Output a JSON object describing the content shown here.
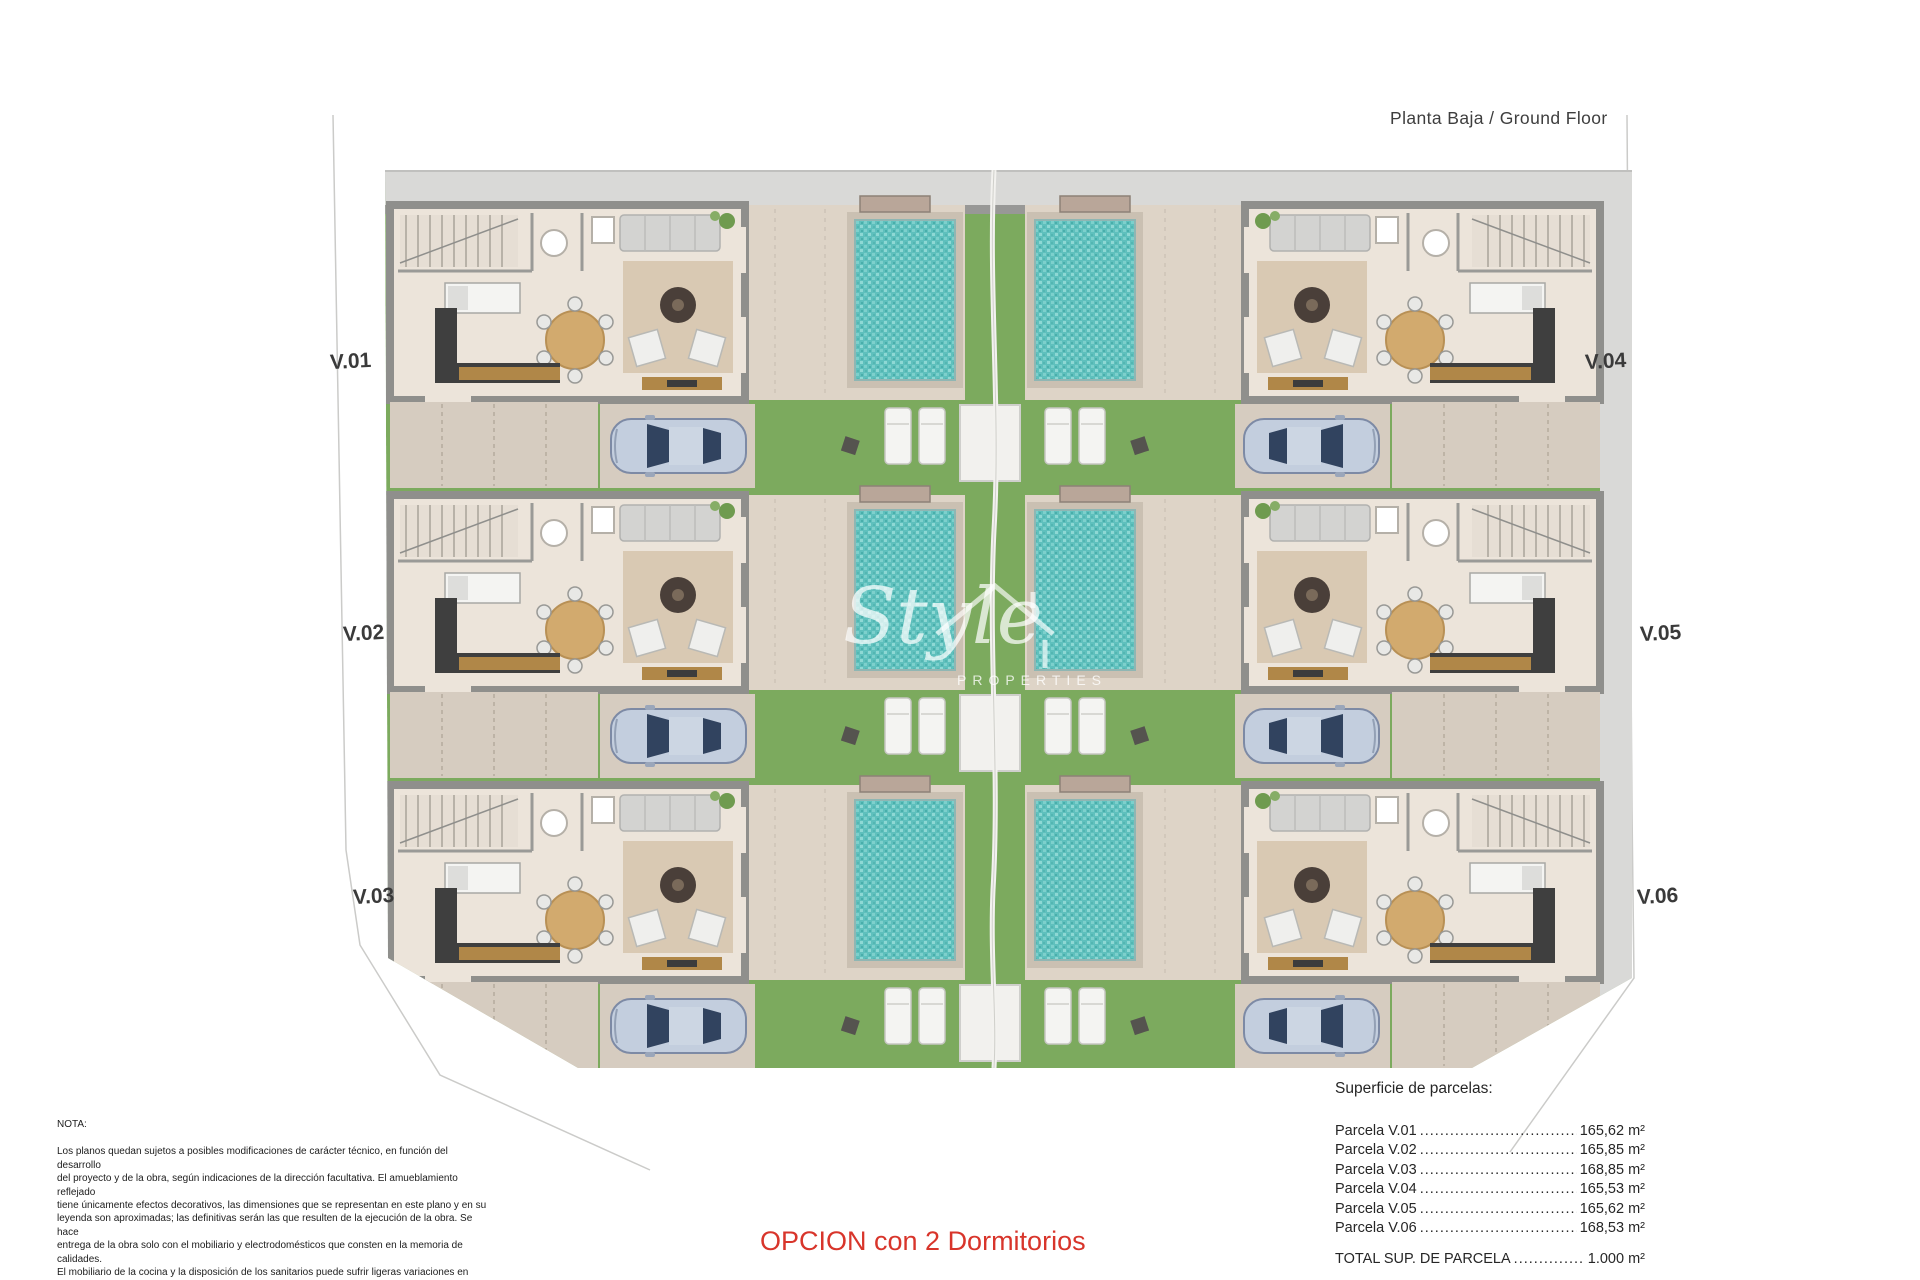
{
  "header": {
    "title": "Planta Baja / Ground Floor"
  },
  "plan": {
    "labels": [
      "V.01",
      "V.02",
      "V.03",
      "V.04",
      "V.05",
      "V.06"
    ],
    "rows": 3,
    "villas_per_row": 2,
    "features": [
      "pool",
      "garden",
      "parking",
      "loungers",
      "central-path"
    ]
  },
  "watermark": {
    "brand": "Style",
    "sub": "PROPERTIES",
    "logo": "house-outline-icon"
  },
  "nota": {
    "heading": "NOTA:",
    "lines": [
      "Los planos quedan sujetos a posibles modificaciones de carácter técnico, en función del desarrollo",
      "del proyecto y de la obra, según indicaciones de la dirección facultativa. El amueblamiento reflejado",
      "tiene únicamente efectos decorativos, las dimensiones que se representan en este plano y en su",
      "leyenda son aproximadas; las definitivas serán las que resulten de la ejecución de la obra. Se hace",
      "entrega de la obra solo con el mobiliario y electrodomésticos que consten en la memoria de calidades.",
      "El mobiliario de la cocina y la disposición de los sanitarios puede sufrir ligeras variaciones en función",
      "del montaje definitivo."
    ]
  },
  "option_label": "OPCION con 2 Dormitorios",
  "parcelas": {
    "heading": "Superficie de parcelas:",
    "leader": "........................................",
    "rows": [
      {
        "label": "Parcela V.01",
        "value": "165,62 m²"
      },
      {
        "label": "Parcela V.02",
        "value": "165,85 m²"
      },
      {
        "label": "Parcela V.03",
        "value": "168,85 m²"
      },
      {
        "label": "Parcela V.04",
        "value": "165,53 m²"
      },
      {
        "label": "Parcela V.05",
        "value": "165,62 m²"
      },
      {
        "label": "Parcela V.06",
        "value": "168,53 m²"
      }
    ],
    "total": {
      "label": "TOTAL SUP. DE PARCELA",
      "value": "1.000 m²"
    }
  },
  "colors": {
    "accent_red": "#d8352b",
    "grass": "#7caa5e",
    "pool_water": "#5fc0bd",
    "terrace": "#ded4c7",
    "floor": "#ece4da",
    "wall_gray": "#8f8f8c",
    "sidewalk": "#d9d9d7",
    "wood": "#b08748"
  }
}
